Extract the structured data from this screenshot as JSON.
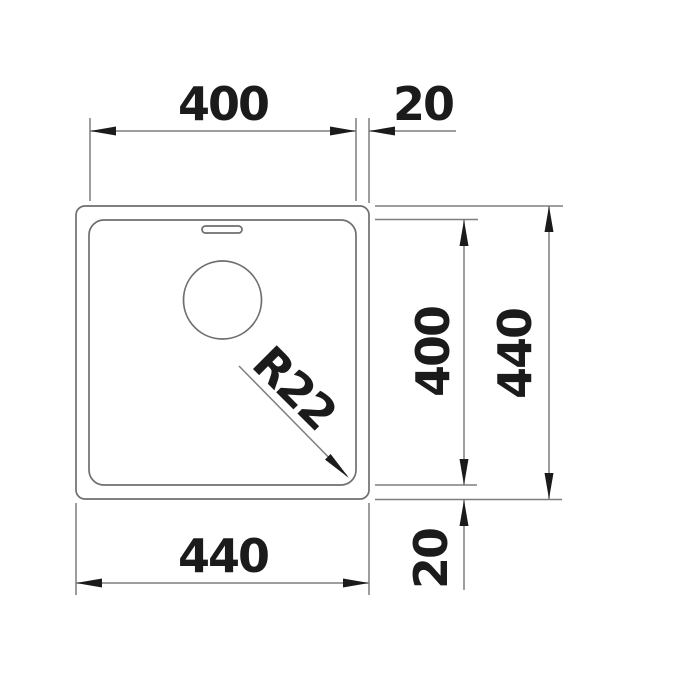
{
  "colors": {
    "background": "#ffffff",
    "line": "#7e7e7e",
    "edge": "#6f6f6f",
    "ink": "#1b1b1b"
  },
  "labels": {
    "inner_width_top": "400",
    "rim_offset_top": "20",
    "inner_height_right": "400",
    "outer_height_right": "440",
    "outer_width_bottom": "440",
    "rim_offset_bottom": "20",
    "corner_radius": "R22"
  }
}
